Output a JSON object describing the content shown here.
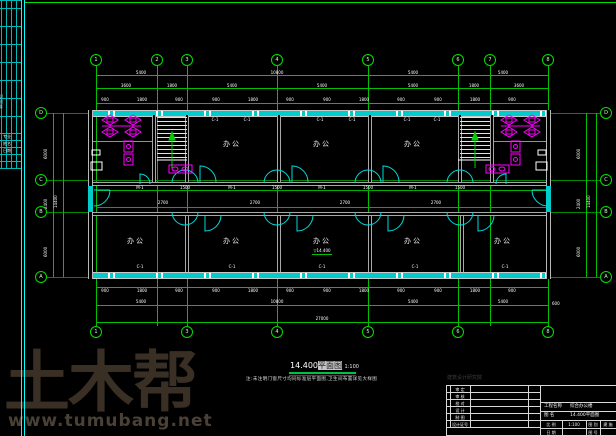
{
  "frame": {
    "left_strip_title": "会签栏",
    "left_strip_rows": [
      "专业",
      "姓名",
      "日期"
    ]
  },
  "watermark": {
    "logo": "土木帮",
    "url": "www.tumubang.net"
  },
  "plan": {
    "room_label": "办公",
    "level_mark": "▽14.400",
    "window_code": "C-1",
    "door_code": "M-1",
    "corridor_dim_a": "1500",
    "corridor_dim_b": "2700"
  },
  "axes": {
    "top": [
      "1",
      "2",
      "3",
      "4",
      "5",
      "6",
      "7",
      "8"
    ],
    "bottom": [
      "1",
      "3",
      "4",
      "5",
      "6",
      "8"
    ],
    "left": [
      "D",
      "C",
      "B",
      "A"
    ],
    "right": [
      "D",
      "C",
      "B",
      "A"
    ]
  },
  "dims": {
    "top_row1": [
      "5400",
      "10800",
      "5400",
      "5400"
    ],
    "top_row2": [
      "3600",
      "1800",
      "5400",
      "5400",
      "5400",
      "1800",
      "3600"
    ],
    "top_row3": [
      "900",
      "1800",
      "900",
      "900",
      "1800",
      "900",
      "900",
      "1800",
      "900",
      "900",
      "1800",
      "900"
    ],
    "bottom_row1": [
      "900",
      "1800",
      "900",
      "900",
      "1800",
      "900",
      "900",
      "1800",
      "900",
      "900",
      "1800",
      "900"
    ],
    "bottom_row2": [
      "5400",
      "10800",
      "5400",
      "5400"
    ],
    "bottom_total": "27000",
    "right_small": "600",
    "left_rows": [
      "6000",
      "2400",
      "6000"
    ],
    "left_total": "14400",
    "right_rows": [
      "6000",
      "2400",
      "6000"
    ],
    "right_total": "14400"
  },
  "title": {
    "num": "14.400",
    "suffix": "平面图",
    "scale": "1:100",
    "note": "注:未注明门窗尺寸均同标准层平面图,卫生间布置详见大样图"
  },
  "titleblock": {
    "company": "建筑设计研究院",
    "rows": [
      "审 定",
      "审 核",
      "校 对",
      "设 计",
      "制 图",
      "设计证号"
    ],
    "project_label": "工程名称",
    "project": "综合办公楼",
    "drawing_label": "图 名",
    "drawing": "14.400平面图",
    "cells": [
      "比 例",
      "1:100",
      "图 别",
      "建 施"
    ],
    "cells2": [
      "日 期",
      "图 号"
    ]
  }
}
